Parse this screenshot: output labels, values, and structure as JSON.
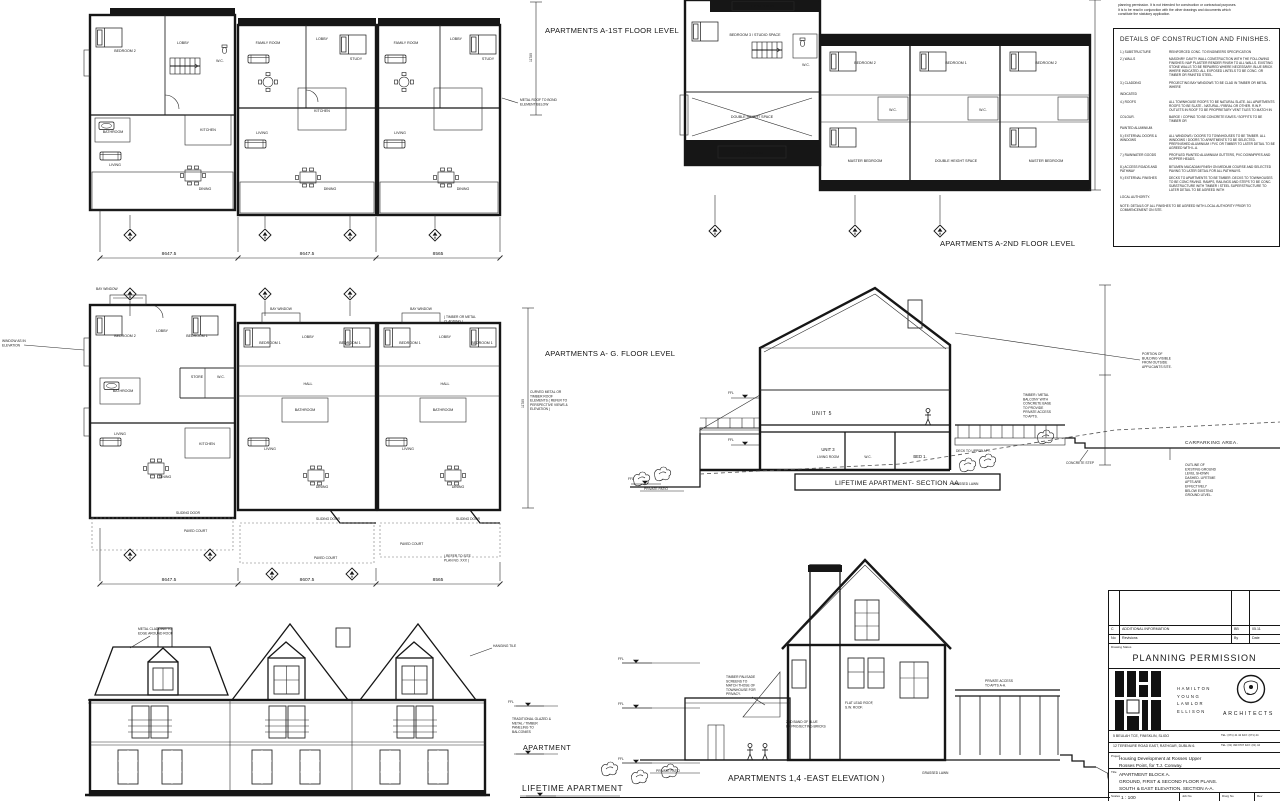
{
  "sheet": {
    "disclaimer_lines": [
      "planning permission. It is not intended for construction or contractual purposes.",
      "It is to be read in conjunction with the other drawings and documents which",
      "constitute the statutory application."
    ]
  },
  "plans": {
    "first": {
      "label": "APARTMENTS A-1ST FLOOR LEVEL",
      "vdim": "11780",
      "dims": [
        "8647.5",
        "8647.5",
        "8565"
      ],
      "note_metal_roof_lines": [
        "METAL ROOF TO BOND",
        "ELEMENT BELOW"
      ],
      "rooms": {
        "bedroom2": "BEDROOM 2",
        "lobby": "LOBBY",
        "wc": "W.C.",
        "bathroom": "BATHROOM",
        "kitchen": "KITCHEN",
        "living": "LIVING",
        "dining": "DINING",
        "family": "FAMILY ROOM",
        "study": "STUDY"
      }
    },
    "second": {
      "label": "APARTMENTS A-2ND FLOOR LEVEL",
      "rooms": {
        "pitched": "PITCHED ROOF",
        "bed3studio": "BEDROOM 3 / STUDIO SPACE",
        "dhs": "DOUBLE HEIGHT SPACE",
        "wc": "W.C.",
        "bedroom1": "BEDROOM 1",
        "bedroom2": "BEDROOM 2",
        "master": "MASTER BEDROOM"
      }
    },
    "ground": {
      "label": "APARTMENTS A- G. FLOOR LEVEL",
      "vdim": "11780",
      "dims": [
        "8647.5",
        "8607.5",
        "8565"
      ],
      "bay": "BAY WINDOW",
      "cladding_note_lines": [
        "( TIMBER OR METAL",
        "CLADDING )"
      ],
      "window_note_lines": [
        "WINDOW AS IN",
        "ELEVATION"
      ],
      "curved_note_lines": [
        "CURVED METAL OR",
        "TIMBER ROOF",
        "ELEMENTS ( REFER TO",
        "PERSPECTIVE VIEWS &",
        "ELEVATION )"
      ],
      "sliding": "SLIDING DOOR",
      "paved": "PAVED COURT",
      "refer_lines": [
        "( REFER TO SITE",
        "PLAN NO. XXX )"
      ],
      "rooms": {
        "bedroom1": "BEDROOM 1",
        "bedroom2": "BEDROOM 2",
        "lobby": "LOBBY",
        "store": "STORE",
        "wc": "W.C.",
        "bathroom": "BATHROOM",
        "hall": "HALL",
        "living": "LIVING",
        "dining": "DINING",
        "kitchen": "KITCHEN"
      }
    }
  },
  "section": {
    "label": "LIFETIME APARTMENT- SECTION AA",
    "unit5": "UNIT 5",
    "unit3": "UNIT 3",
    "living_room": "LIVING ROOM",
    "wc": "W.C.",
    "bed1": "BED 1.",
    "deck_note": "DECK TO UPPER APT.",
    "grassed": "GRASSED LAWN",
    "patio": "PRIVATE PATIO",
    "step_note": "CONCRETE STEP",
    "carpark": "CARPARKING AREA.",
    "ffl": "FFL",
    "balcony_note_lines": [
      "TIMBER / METAL",
      "BALCONY WITH",
      "CONCRETE BASE",
      "TO PROVIDE",
      "PRIVATE ACCESS",
      "TO APTS."
    ],
    "portion_note_lines": [
      "PORTION OF",
      "BUILDING VISIBLE",
      "FROM OUTSIDE",
      "APPLICANTS SITE."
    ],
    "outline_note_lines": [
      "OUTLINE OF",
      "EXISTING GROUND",
      "LEVEL SHOWN",
      "DASHED. LIFETIME",
      "APTS ARE",
      "EFFECTIVELY",
      "BELOW EXISTING",
      "GROUND LEVEL."
    ]
  },
  "east": {
    "label": "APARTMENTS 1,4 -EAST ELEVATION )",
    "patio": "PRIVATE PATIO",
    "grassed": "GRASSED LAWN",
    "ffl": "FFL",
    "palisade_note_lines": [
      "TIMBER PALISADE",
      "SCREENS TO",
      "MATCH THOSE OF",
      "TOWNHOUSE FOR",
      "PRIVACY."
    ],
    "brick_note_lines": [
      "2ND BAND OF BLUE",
      "BK PROJECTING BRICKS"
    ],
    "flat_roof_note_lines": [
      "FLAT LEAD ROOF,",
      "S.W. ROOF."
    ],
    "access_note_lines": [
      "PRIVATE ACCESS",
      "TO APTS A-A."
    ]
  },
  "south": {
    "label": "LIFETIME APARTMENT",
    "apartment": "APARTMENT",
    "ffl": "FFL",
    "cladding_note_lines": [
      "METAL CLADDING TO",
      "EDGE AROUND ROOF"
    ],
    "hanging_note": "HANGING TILE",
    "balconies_note_lines": [
      "TRADITIONAL GLAZED &",
      "METAL / TIMBER",
      "PANELING TO",
      "BALCONIES"
    ]
  },
  "finishes": {
    "title": "DETAILS OF CONSTRUCTION AND FINISHES.",
    "items": [
      {
        "term": "1.)   SUBSTRUCTURE",
        "desc": "REINFORCED CONC. TO ENGINEERS SPECIFICATION"
      },
      {
        "term": "2.)   WALLS",
        "desc": "MASONRY CAVITY WALL CONSTRUCTION WITH THE FOLLOWING FINISHES: NAP PLASTER RENDER FINISH TO ALL WALLS. EXISTING STONE WALLS TO BE REPAIRED WHERE NECESSARY. BLUE BRICK WHERE INDICATED. ALL EXPOSED LINTELS TO BE CONC. OR TIMBER OR PAINTED STEEL."
      },
      {
        "term": "3.)   CLADDING",
        "desc": "PROJECTING BAY WINDOWS TO BE CLAD IN TIMBER OR METAL WHERE"
      },
      {
        "term": "INDICATED",
        "desc": ""
      },
      {
        "term": "4.)   ROOFS",
        "desc": "ALL TOWNHOUSE ROOFS TO BE NATURAL SLATE. ALL APARTMENTS ROOFS TO BE SLATE - NATURAL / FIBRAL OR OTHER. R.W.P. OUTLETS IN ROOF TO BE PROPRIETARY VENT TILES TO MATCH IN"
      },
      {
        "term": "COLOUR.",
        "desc": "BARGE / COPING TO BE CONCRETE EAVES / SOFFITS TO BE TIMBER OR"
      },
      {
        "term": "PAINTED ALUMINIUM.",
        "desc": ""
      },
      {
        "term": "5.)   EXTERNAL DOORS & WINDOWS",
        "desc": "ALL WINDOWS / DOORS TO TOWNHOUSES TO BE TIMBER. ALL WINDOWS / DOORS TO APARTMENTS TO BE SELECTED. PREFINISHED ALUMINIUM / PVC OR TIMBER TO LATER DETAIL TO BE AGREED WITH L.A."
      },
      {
        "term": "7.)   RAINWATER GOODS",
        "desc": "PROFILED PAINTED ALUMINIUM GUTTERS, PVC DOWNPIPES AND HOPPER HEADS."
      },
      {
        "term": "8.)   ACCESS ROADS AND PATHWAY",
        "desc": "BITUMEN MACADAM FINISH ON MEDIUM COURSE AND SELECTED PAVING TO LATER DETAIL FOR ALL PATHWAYS."
      },
      {
        "term": "9.)   EXTERNAL FINISHES",
        "desc": "DECKS TO APARTMENTS TO BE TIMBER. DECKS TO TOWNHOUSES TO BE CONC PAVING. RAMPS, RAILINGS AND STEPS TO BE CONC. SUBSTRUCTURE WITH TIMBER / STEEL SUPERSTRUCTURE TO LATER DETAIL TO BE AGREED WITH"
      },
      {
        "term": "LOCAL AUTHORITY.",
        "desc": ""
      }
    ],
    "note": "NOTE: DETAILS OF ALL FINISHES TO BE AGREED WITH LOCAL AUTHORITY PRIOR TO COMMENCEMENT ON SITE."
  },
  "title_block": {
    "rev_row": {
      "no": "C",
      "desc": "ADDITIONAL INFORMATION",
      "by": "BB",
      "date": "05.11"
    },
    "rev_headers": {
      "no": "No",
      "desc": "Revisions",
      "by": "By",
      "date": "Date"
    },
    "status_label": "Drawing Status",
    "status": "PLANNING PERMISSION",
    "firm_lines": [
      "HAMILTON",
      "YOUNG",
      "LAWLOR",
      "ELLISON"
    ],
    "architects": "ARCHITECTS",
    "addr1": "5 BEULAH TCE, FINISKLIN, SLIGO",
    "addr1_tel": "TEL: (071) 41 42  FAX: (071) 44",
    "addr2": "12 TERENURE ROAD EAST, RATHGAR, DUBLIN 6.",
    "addr2_tel": "TEL: (01) 490 9707  FAX: (01) 44",
    "project_label": "Project",
    "project_lines": [
      "Housing Development at Rosses Upper",
      "Rosses Point, for T.J. Conway."
    ],
    "title_label": "Title",
    "title_lines": [
      "APARTMENT BLOCK A.",
      "GROUND, FIRST & SECOND FLOOR PLANS.",
      "SOUTH & EAST ELEVATION. SECTION  A-A."
    ],
    "scales_label": "Scales",
    "scale": "1 : 100",
    "job_label": "Job No",
    "drwg_label": "Drwg No",
    "rev_label": "Rev"
  }
}
